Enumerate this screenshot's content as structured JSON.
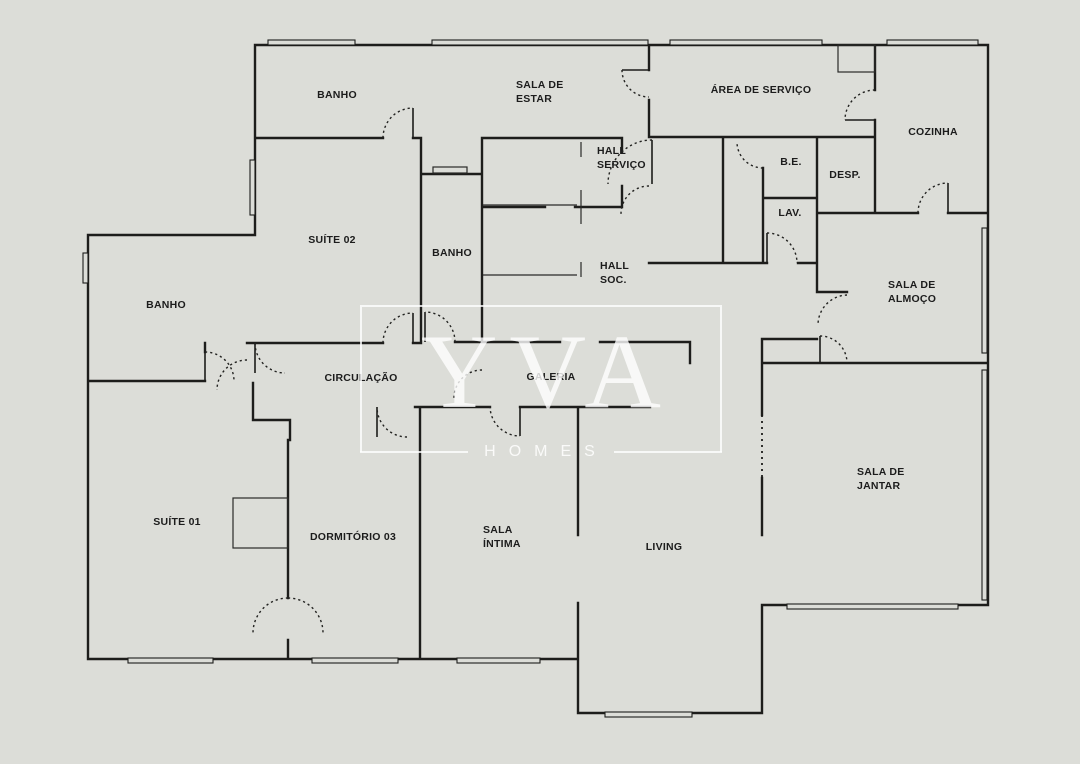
{
  "watermark": {
    "brand": "YVA",
    "tagline": "HOMES"
  },
  "rooms": [
    {
      "id": "banho-top",
      "label": "BANHO"
    },
    {
      "id": "sala-de-estar",
      "label": "SALA DE\nESTAR"
    },
    {
      "id": "area-de-servico",
      "label": "ÁREA DE SERVIÇO"
    },
    {
      "id": "cozinha",
      "label": "COZINHA"
    },
    {
      "id": "hall-servico",
      "label": "HALL\nSERVIÇO"
    },
    {
      "id": "be",
      "label": "B.E."
    },
    {
      "id": "desp",
      "label": "DESP."
    },
    {
      "id": "lav",
      "label": "LAV."
    },
    {
      "id": "suite-02",
      "label": "SUÍTE 02"
    },
    {
      "id": "banho-meio",
      "label": "BANHO"
    },
    {
      "id": "hall-soc",
      "label": "HALL\nSOC."
    },
    {
      "id": "sala-de-almoco",
      "label": "SALA DE\nALMOÇO"
    },
    {
      "id": "banho-esquerda",
      "label": "BANHO"
    },
    {
      "id": "circulacao",
      "label": "CIRCULAÇÃO"
    },
    {
      "id": "galeria",
      "label": "GALERIA"
    },
    {
      "id": "sala-de-jantar",
      "label": "SALA DE\nJANTAR"
    },
    {
      "id": "suite-01",
      "label": "SUÍTE 01"
    },
    {
      "id": "dormitorio-03",
      "label": "DORMITÓRIO 03"
    },
    {
      "id": "sala-intima",
      "label": "SALA\nÍNTIMA"
    },
    {
      "id": "living",
      "label": "LIVING"
    }
  ],
  "colors": {
    "background": "#dcddd8",
    "wall": "#1d1d1b",
    "watermark": "#ffffff"
  }
}
